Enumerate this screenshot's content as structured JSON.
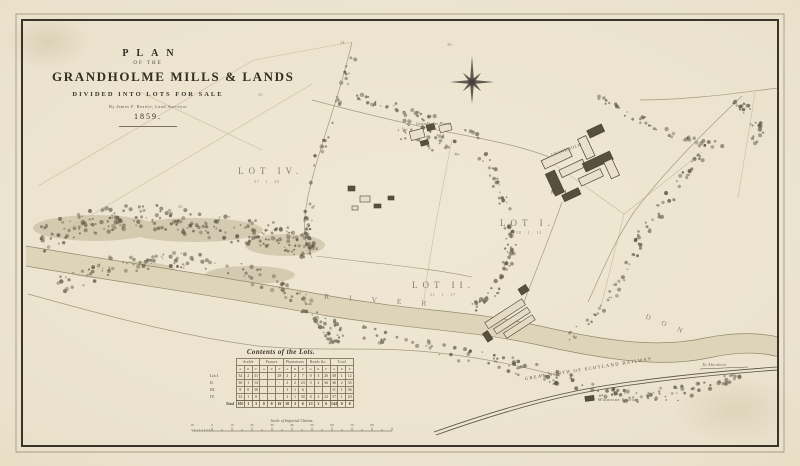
{
  "title_block": {
    "line1": "PLAN",
    "line2": "OF THE",
    "line3": "GRANDHOLME MILLS & LANDS",
    "line4": "DIVIDED INTO LOTS FOR SALE",
    "line5": "By James F. Beattie, Land Surveyor",
    "line6": "1859."
  },
  "map": {
    "labels": {
      "lot1": "LOT I.",
      "lot1_area": "38 . 1 . 12",
      "lot2": "LOT II.",
      "lot2_area": "31 . 1 . 17",
      "lot4": "LOT IV.",
      "lot4_area": "37 . 1 . 20",
      "grandholm": "GRANDHOLM",
      "mills": "MILLS",
      "place": "Grandholm Place",
      "river": "RIVER",
      "don": "DON",
      "railway": "GREAT NORTH OF SCOTLAND RAILWAY",
      "station": "Woodside Station",
      "to_aberdeen": "To Aberdeen"
    },
    "field_numbers": [
      "52",
      "34",
      "26",
      "20"
    ]
  },
  "table": {
    "title": "Contents of the Lots.",
    "col_headers": [
      "Arable",
      "Pasture",
      "Plantations",
      "Roads &c.",
      "Total"
    ],
    "sub_headers": [
      "A",
      "R",
      "P"
    ],
    "rows": [
      {
        "label": "Lot I.",
        "cells": [
          "34",
          "2",
          "31",
          "·",
          "·",
          "28",
          "2",
          "2",
          "7",
          "0",
          "3",
          "26",
          "38",
          "1",
          "12"
        ]
      },
      {
        "label": "II.",
        "cells": [
          "30",
          "1",
          "14",
          "·",
          "·",
          "·",
          "2",
          "2",
          "23",
          "3",
          "2",
          "36",
          "36",
          "2",
          "33"
        ]
      },
      {
        "label": "III.",
        "cells": [
          "8",
          "0",
          "30",
          "·",
          "·",
          "·",
          "3",
          "1",
          "6",
          "·",
          "·",
          "·",
          "11",
          "1",
          "36"
        ]
      },
      {
        "label": "IV.",
        "cells": [
          "33",
          "1",
          "8",
          "·",
          "·",
          "·",
          "3",
          "1",
          "30",
          "0",
          "2",
          "22",
          "37",
          "1",
          "20"
        ]
      },
      {
        "label": "Total",
        "cells": [
          "105",
          "1",
          "3",
          "0",
          "0",
          "16",
          "10",
          "3",
          "6",
          "13",
          "3",
          "6",
          "144",
          "0",
          "8"
        ],
        "total": true
      }
    ]
  },
  "scale_bar": {
    "caption": "Scale of Imperial Chains.",
    "numbers": [
      "10",
      "0",
      "10",
      "20",
      "30",
      "40",
      "50",
      "60",
      "70",
      "80"
    ]
  }
}
